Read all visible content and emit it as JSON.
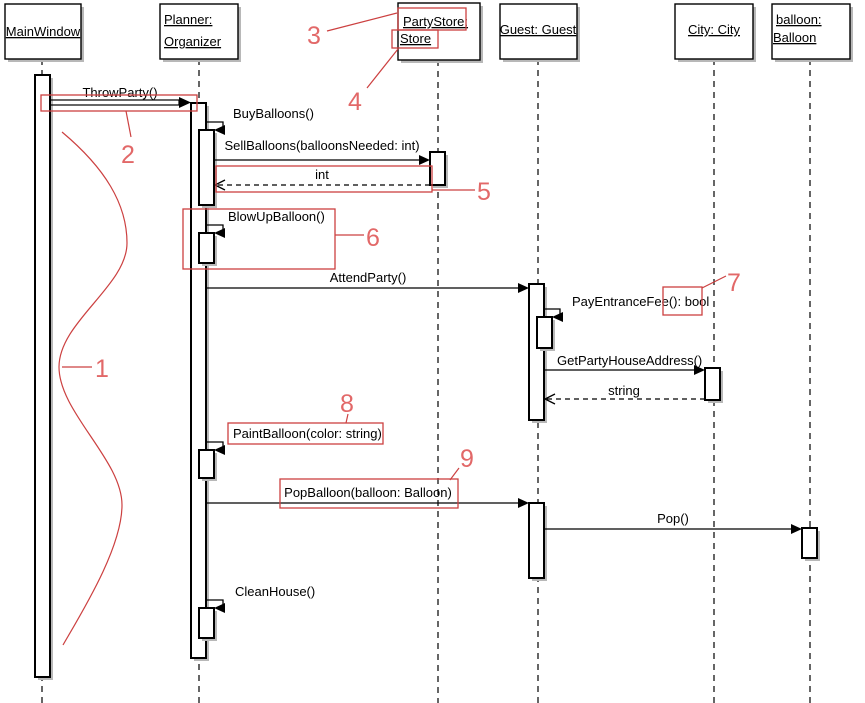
{
  "diagram_type": "UML sequence diagram with numbered callouts",
  "colors": {
    "annotation_line": "#cc4040",
    "annotation_number": "#e26868",
    "shadow": "#b8b8b8",
    "diagram_line": "#000000",
    "background": "#ffffff"
  },
  "lifelines": [
    {
      "label": "MainWindow",
      "lines": [
        "MainWindow"
      ]
    },
    {
      "label": "Planner: Organizer",
      "lines": [
        "Planner:",
        "Organizer"
      ]
    },
    {
      "label": "PartyStore: Store",
      "lines": [
        "PartyStore:",
        "Store"
      ]
    },
    {
      "label": "Guest: Guest",
      "lines": [
        "Guest: Guest"
      ]
    },
    {
      "label": "City: City",
      "lines": [
        "City: City"
      ]
    },
    {
      "label": "balloon: Balloon",
      "lines": [
        "balloon:",
        "Balloon"
      ]
    }
  ],
  "messages": [
    {
      "label": "ThrowParty()",
      "from": "MainWindow",
      "to": "Planner: Organizer",
      "kind": "call"
    },
    {
      "label": "BuyBalloons()",
      "from": "Planner: Organizer",
      "to": "Planner: Organizer",
      "kind": "self-call"
    },
    {
      "label": "SellBalloons(balloonsNeeded: int)",
      "from": "Planner: Organizer",
      "to": "PartyStore: Store",
      "kind": "call"
    },
    {
      "label": "int",
      "from": "PartyStore: Store",
      "to": "Planner: Organizer",
      "kind": "return"
    },
    {
      "label": "BlowUpBalloon()",
      "from": "Planner: Organizer",
      "to": "Planner: Organizer",
      "kind": "self-call"
    },
    {
      "label": "AttendParty()",
      "from": "Planner: Organizer",
      "to": "Guest: Guest",
      "kind": "call"
    },
    {
      "label": "PayEntranceFee(): bool",
      "from": "Guest: Guest",
      "to": "Guest: Guest",
      "kind": "self-call"
    },
    {
      "label": "GetPartyHouseAddress()",
      "from": "Guest: Guest",
      "to": "City: City",
      "kind": "call"
    },
    {
      "label": "string",
      "from": "City: City",
      "to": "Guest: Guest",
      "kind": "return"
    },
    {
      "label": "PaintBalloon(color: string)",
      "from": "Planner: Organizer",
      "to": "Planner: Organizer",
      "kind": "self-call"
    },
    {
      "label": "PopBalloon(balloon: Balloon)",
      "from": "Planner: Organizer",
      "to": "Guest: Guest",
      "kind": "call"
    },
    {
      "label": "Pop()",
      "from": "Guest: Guest",
      "to": "balloon: Balloon",
      "kind": "call"
    },
    {
      "label": "CleanHouse()",
      "from": "Planner: Organizer",
      "to": "Planner: Organizer",
      "kind": "self-call"
    }
  ],
  "callouts": [
    {
      "number": "1",
      "target": "freehand curve beside MainWindow activation bar"
    },
    {
      "number": "2",
      "target": "ThrowParty() message arrow"
    },
    {
      "number": "3",
      "target": "PartyStore: object name"
    },
    {
      "number": "4",
      "target": "Store class name"
    },
    {
      "number": "5",
      "target": "int return message"
    },
    {
      "number": "6",
      "target": "BlowUpBalloon() self-call block"
    },
    {
      "number": "7",
      "target": "(): bool return type of PayEntranceFee"
    },
    {
      "number": "8",
      "target": "PaintBalloon(color: string) message label"
    },
    {
      "number": "9",
      "target": "PopBalloon(balloon: Balloon) message label"
    }
  ]
}
